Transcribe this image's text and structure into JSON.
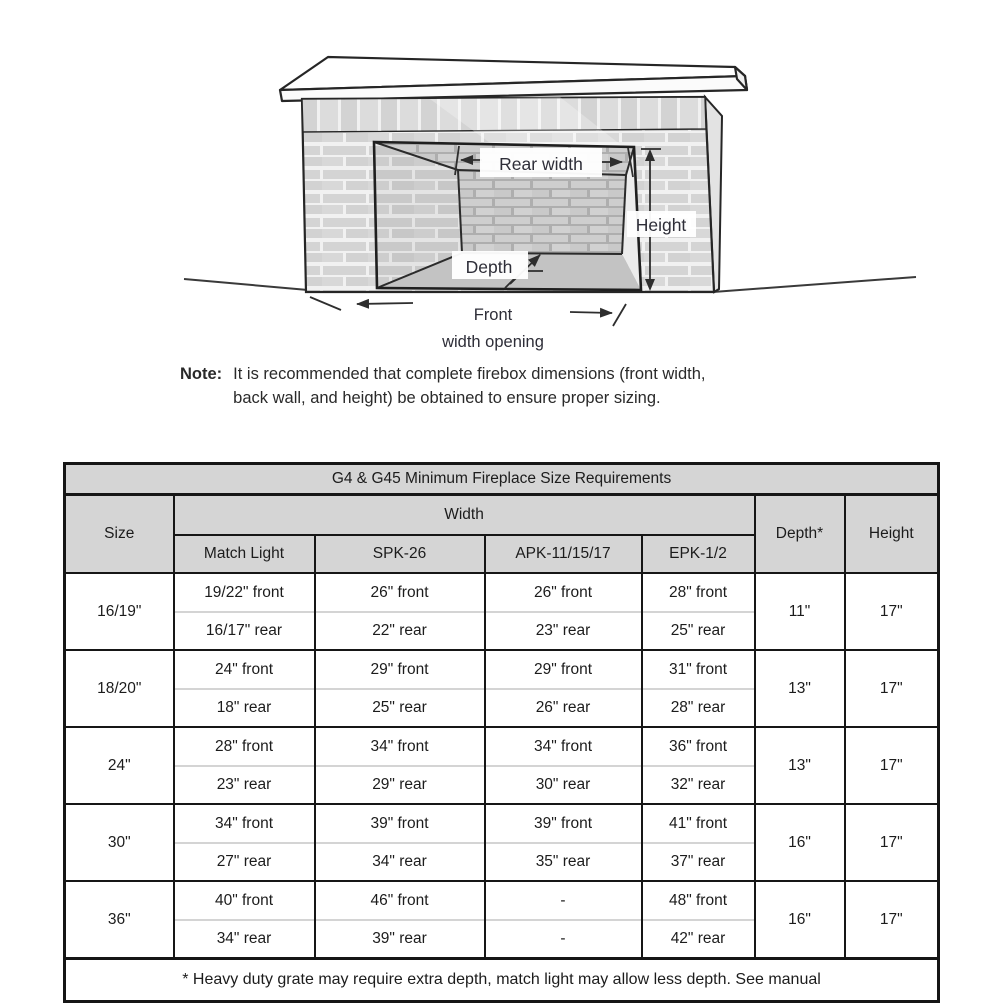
{
  "colors": {
    "header_bg": "#d5d5d5",
    "table_border": "#161616",
    "text": "#1c1c1c",
    "diagram_line": "#2e2e2e"
  },
  "diagram": {
    "labels": {
      "rear_width": "Rear width",
      "height": "Height",
      "depth": "Depth",
      "front_line1": "Front",
      "front_line2": "width opening"
    }
  },
  "note": {
    "label": "Note:",
    "line1": "It is recommended that complete firebox dimensions (front width,",
    "line2": "back wall, and height) be obtained to ensure proper sizing."
  },
  "table": {
    "title": "G4 & G45 Minimum Fireplace Size Requirements",
    "col_size": "Size",
    "col_width": "Width",
    "col_depth": "Depth*",
    "col_height": "Height",
    "subcols": [
      "Match Light",
      "SPK-26",
      "APK-11/15/17",
      "EPK-1/2"
    ],
    "rows": [
      {
        "size": "16/19\"",
        "w": [
          {
            "f": "19/22\" front",
            "r": "16/17\" rear"
          },
          {
            "f": "26\" front",
            "r": "22\" rear"
          },
          {
            "f": "26\" front",
            "r": "23\" rear"
          },
          {
            "f": "28\" front",
            "r": "25\" rear"
          }
        ],
        "depth": "11\"",
        "height": "17\""
      },
      {
        "size": "18/20\"",
        "w": [
          {
            "f": "24\" front",
            "r": "18\" rear"
          },
          {
            "f": "29\" front",
            "r": "25\" rear"
          },
          {
            "f": "29\" front",
            "r": "26\" rear"
          },
          {
            "f": "31\" front",
            "r": "28\" rear"
          }
        ],
        "depth": "13\"",
        "height": "17\""
      },
      {
        "size": "24\"",
        "w": [
          {
            "f": "28\" front",
            "r": "23\" rear"
          },
          {
            "f": "34\" front",
            "r": "29\" rear"
          },
          {
            "f": "34\" front",
            "r": "30\" rear"
          },
          {
            "f": "36\" front",
            "r": "32\" rear"
          }
        ],
        "depth": "13\"",
        "height": "17\""
      },
      {
        "size": "30\"",
        "w": [
          {
            "f": "34\" front",
            "r": "27\" rear"
          },
          {
            "f": "39\" front",
            "r": "34\" rear"
          },
          {
            "f": "39\" front",
            "r": "35\" rear"
          },
          {
            "f": "41\" front",
            "r": "37\" rear"
          }
        ],
        "depth": "16\"",
        "height": "17\""
      },
      {
        "size": "36\"",
        "w": [
          {
            "f": "40\" front",
            "r": "34\" rear"
          },
          {
            "f": "46\" front",
            "r": "39\" rear"
          },
          {
            "f": "-",
            "r": "-"
          },
          {
            "f": "48\" front",
            "r": "42\" rear"
          }
        ],
        "depth": "16\"",
        "height": "17\""
      }
    ],
    "footnote": "* Heavy duty grate may require extra depth, match light may allow less depth. See manual"
  }
}
